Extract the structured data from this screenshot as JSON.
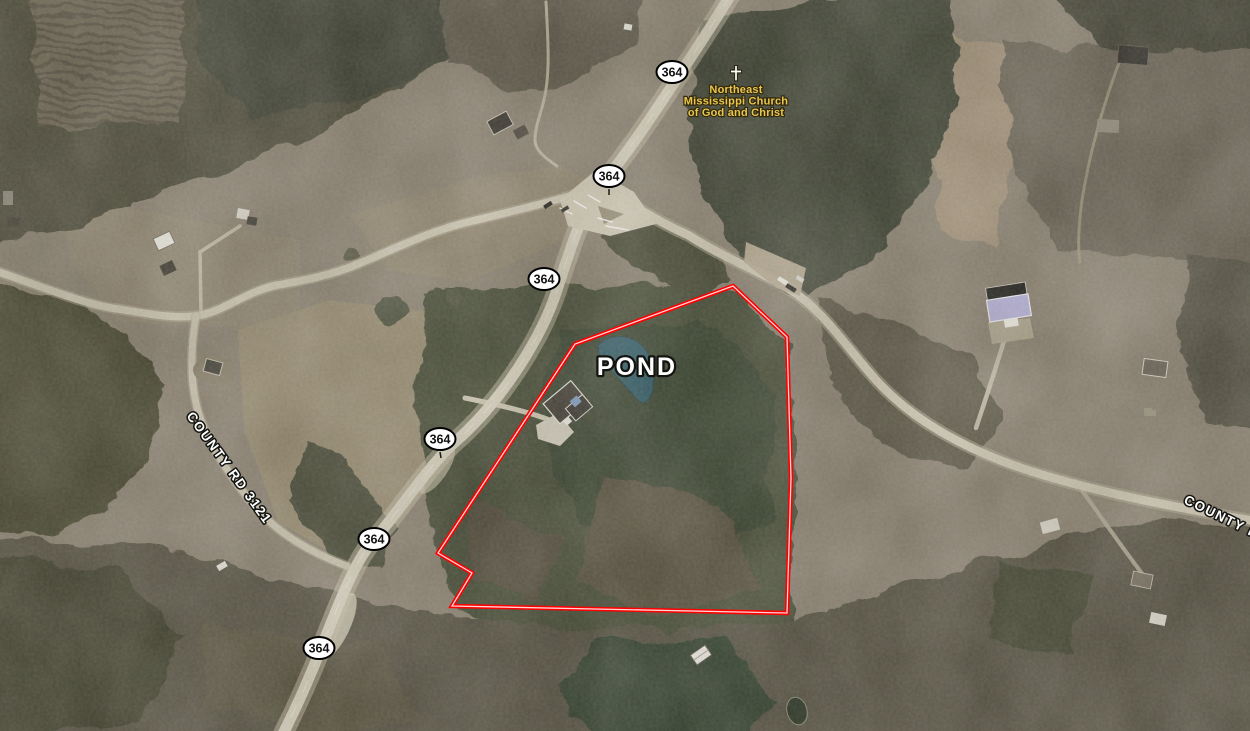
{
  "map": {
    "type": "satellite aerial imagery",
    "annotations": {
      "pond_label": {
        "text": "POND",
        "color": "#ffffff",
        "outline": "#000000"
      },
      "church_poi": {
        "icon": "christian-cross",
        "lines": [
          "Northeast",
          "Mississippi Church",
          "of God and Christ"
        ],
        "color": "#e9c64f"
      },
      "road_labels": {
        "left": {
          "text": "COUNTY RD 3121",
          "x": 186,
          "y": 416,
          "angle": 54
        },
        "right": {
          "text": "COUNTY RD",
          "x": 1183,
          "y": 503,
          "angle": 26
        }
      },
      "route_shields": {
        "route": "364",
        "fill": "#ffffff",
        "border": "#000000",
        "positions": [
          {
            "x": 672,
            "y": 72
          },
          {
            "x": 609,
            "y": 176
          },
          {
            "x": 544,
            "y": 279
          },
          {
            "x": 440,
            "y": 439
          },
          {
            "x": 374,
            "y": 539
          },
          {
            "x": 319,
            "y": 648
          }
        ]
      },
      "property_boundary": {
        "color": "#ff0000",
        "core_color": "#ffd6d6",
        "points": [
          [
            733,
            286
          ],
          [
            787,
            337
          ],
          [
            791,
            478
          ],
          [
            787,
            613
          ],
          [
            452,
            606
          ],
          [
            472,
            573
          ],
          [
            438,
            553
          ],
          [
            575,
            344
          ]
        ]
      },
      "pond_color": "#2c5a69"
    }
  }
}
